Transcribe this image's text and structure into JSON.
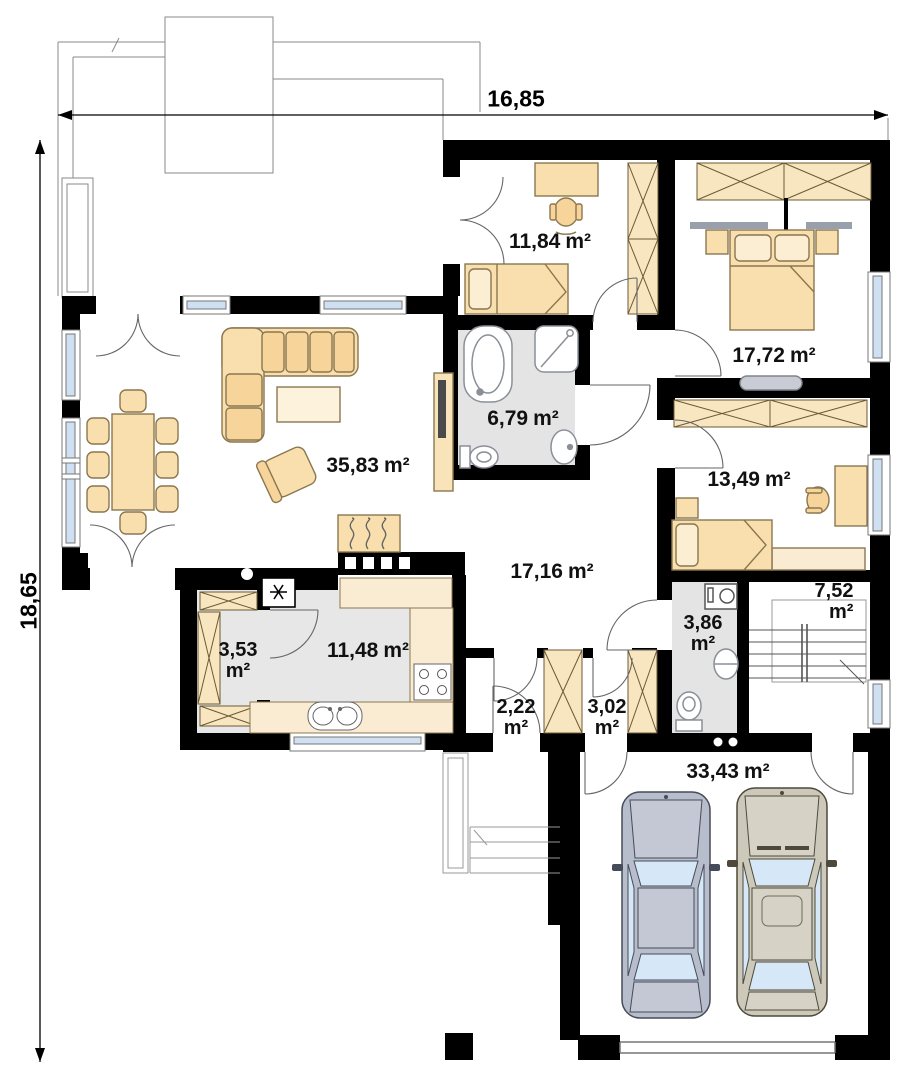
{
  "plan": {
    "dimensions": {
      "width": "16,85",
      "height": "18,65"
    },
    "rooms": [
      {
        "id": "bedroom-1",
        "area": "11,84",
        "unit": "m²"
      },
      {
        "id": "master-bedroom",
        "area": "17,72",
        "unit": "m²"
      },
      {
        "id": "bathroom",
        "area": "6,79",
        "unit": "m²"
      },
      {
        "id": "living-room",
        "area": "35,83",
        "unit": "m²"
      },
      {
        "id": "bedroom-2",
        "area": "13,49",
        "unit": "m²"
      },
      {
        "id": "hall",
        "area": "17,16",
        "unit": "m²"
      },
      {
        "id": "staircase",
        "area": "7,52",
        "unit": "m²"
      },
      {
        "id": "wc",
        "area": "3,86",
        "unit": "m²"
      },
      {
        "id": "pantry",
        "area": "3,53",
        "unit": "m²"
      },
      {
        "id": "kitchen",
        "area": "11,48",
        "unit": "m²"
      },
      {
        "id": "vestibule",
        "area": "2,22",
        "unit": "m²"
      },
      {
        "id": "corridor",
        "area": "3,02",
        "unit": "m²"
      },
      {
        "id": "garage",
        "area": "33,43",
        "unit": "m²"
      }
    ],
    "icons": [
      "snowflake-icon",
      "flame-icon",
      "shower-icon",
      "cooktop-icon"
    ],
    "colors": {
      "wall": "#000000",
      "furniture": "#f8dca6",
      "furniture_light": "#fbeed2",
      "wardrobe": "#f8e6c0",
      "floor_gray": "#e4e4e4",
      "window_glass": "#cfe0f2",
      "car_left_body": "#b7bdcb",
      "car_right_body": "#ccc9bb",
      "car_glass": "#d6e8f7",
      "radiator": "#c9ccd4"
    }
  }
}
